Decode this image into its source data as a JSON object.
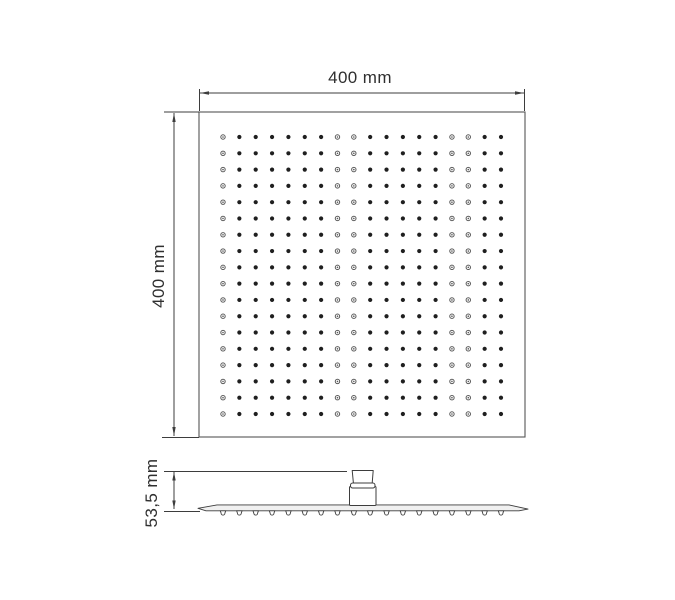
{
  "labels": {
    "width": "400 mm",
    "height": "400 mm",
    "thickness": "53,5 mm"
  },
  "top_view": {
    "nozzle_grid": {
      "cols": 18,
      "rows": 18,
      "ring_columns": [
        0,
        7,
        8,
        14,
        15
      ]
    }
  },
  "side_view": {
    "nozzle_count": 18
  },
  "colors": {
    "background": "#ffffff",
    "line": "#3d3d3d",
    "text": "#2f2f2f",
    "dot": "#1f1f1f",
    "ring_dot": "#5a5a5a",
    "plate_fill": "#f0f0f0"
  }
}
